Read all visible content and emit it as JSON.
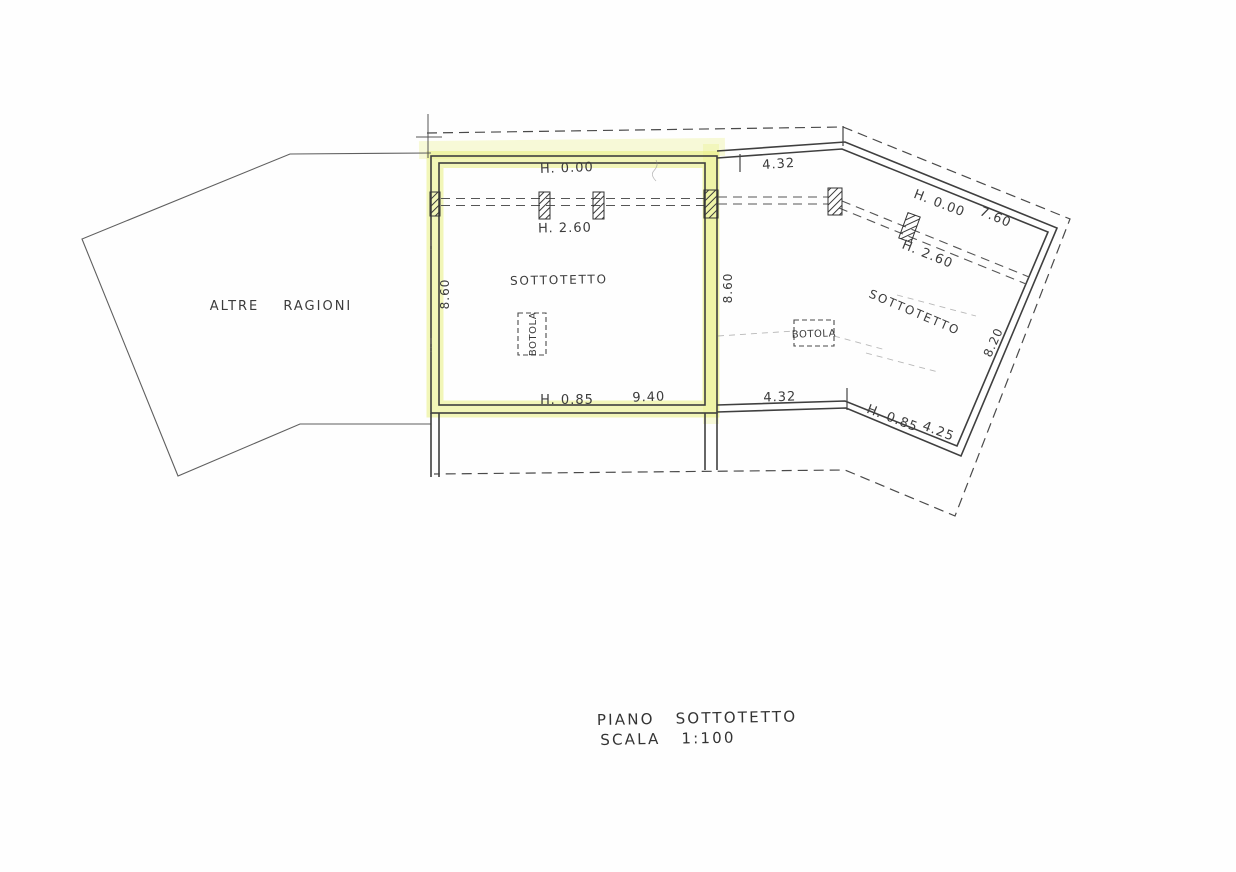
{
  "plan": {
    "adjacent_area_label": "ALTRE RAGIONI",
    "left_room": {
      "name": "SOTTOTETTO",
      "trapdoor_label": "BOTOLA",
      "height_ridge": "H. 0.00",
      "height_mid": "H. 2.60",
      "height_eave": "H. 0.85",
      "width": "9.40",
      "depth": "8.60"
    },
    "right_room": {
      "name": "SOTTOTETTO",
      "trapdoor_label": "BOTOLA",
      "height_ridge": "H. 0.00",
      "height_mid": "H. 2.60",
      "height_eave": "H. 0.85",
      "depth_left": "8.60",
      "top_width": "4.32",
      "top_slant_width": "7.60",
      "right_side": "8.20",
      "bottom_width": "4.32",
      "bottom_slant_width": "4.25"
    },
    "caption": {
      "line1": "PIANO SOTTOTETTO",
      "line2": "SCALA 1:100"
    },
    "colors": {
      "highlight": "#e7ef7d",
      "ink": "#3f3f3f"
    }
  }
}
